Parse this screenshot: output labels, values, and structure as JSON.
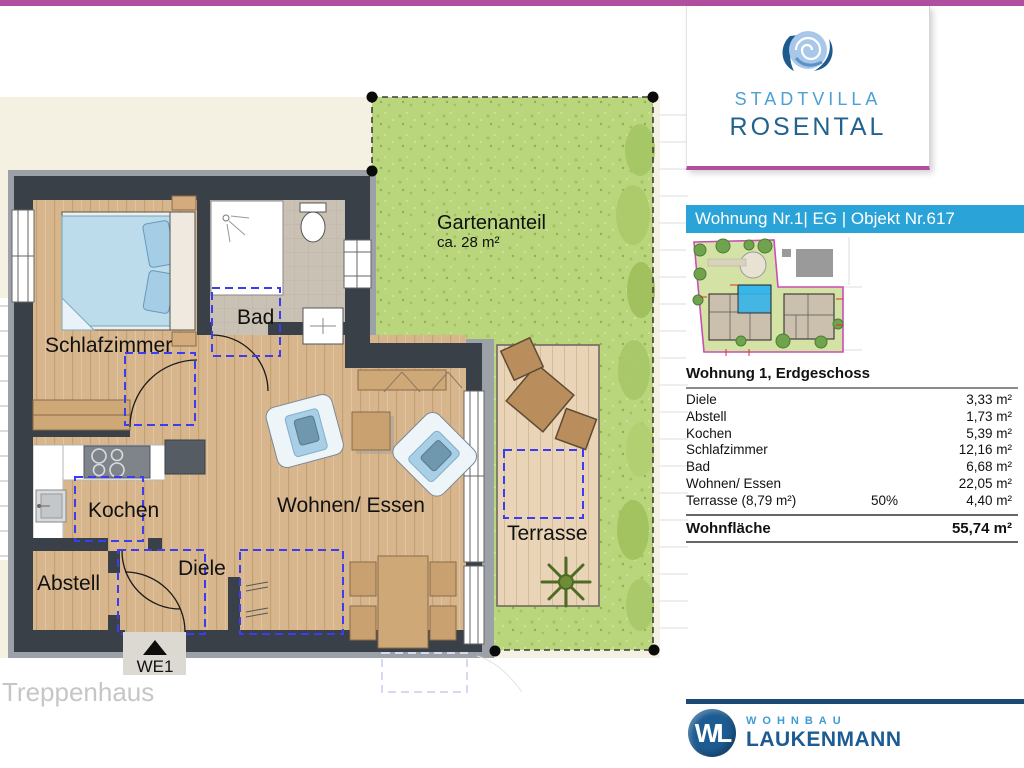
{
  "colors": {
    "accent_magenta": "#b04f9e",
    "accent_teal": "#2aa3d8",
    "brand_navy": "#1c4a77",
    "brand_blue_light": "#3f9bd6",
    "wall": "#3a4047",
    "wood_floor": "#d8b68d",
    "grass": "#b9d67c",
    "hotspot_blue": "#3d3df0"
  },
  "logo_card": {
    "line1": "STADTVILLA",
    "line2": "ROSENTAL"
  },
  "header": {
    "title": "Wohnung Nr.1| EG | Objekt Nr.617"
  },
  "plan": {
    "rooms": {
      "schlafzimmer": "Schlafzimmer",
      "bad": "Bad",
      "kochen": "Kochen",
      "abstell": "Abstell",
      "diele": "Diele",
      "wohnen": "Wohnen/ Essen",
      "terrasse": "Terrasse"
    },
    "garden": {
      "label": "Gartenanteil",
      "area": "ca. 28 m²"
    },
    "entrance_label": "WE1",
    "staircase_label": "Treppenhaus"
  },
  "table": {
    "title": "Wohnung 1, Erdgeschoss",
    "rows": [
      {
        "name": "Diele",
        "pct": "",
        "value": "3,33 m²"
      },
      {
        "name": "Abstell",
        "pct": "",
        "value": "1,73 m²"
      },
      {
        "name": "Kochen",
        "pct": "",
        "value": "5,39 m²"
      },
      {
        "name": "Schlafzimmer",
        "pct": "",
        "value": "12,16 m²"
      },
      {
        "name": "Bad",
        "pct": "",
        "value": "6,68 m²"
      },
      {
        "name": "Wohnen/ Essen",
        "pct": "",
        "value": "22,05 m²"
      },
      {
        "name": "Terrasse (8,79 m²)",
        "pct": "50%",
        "value": "4,40 m²"
      }
    ],
    "total": {
      "name": "Wohnfläche",
      "value": "55,74 m²"
    }
  },
  "brand": {
    "monogram": "WL",
    "line1": "WOHNBAU",
    "line2": "LAUKENMANN"
  }
}
